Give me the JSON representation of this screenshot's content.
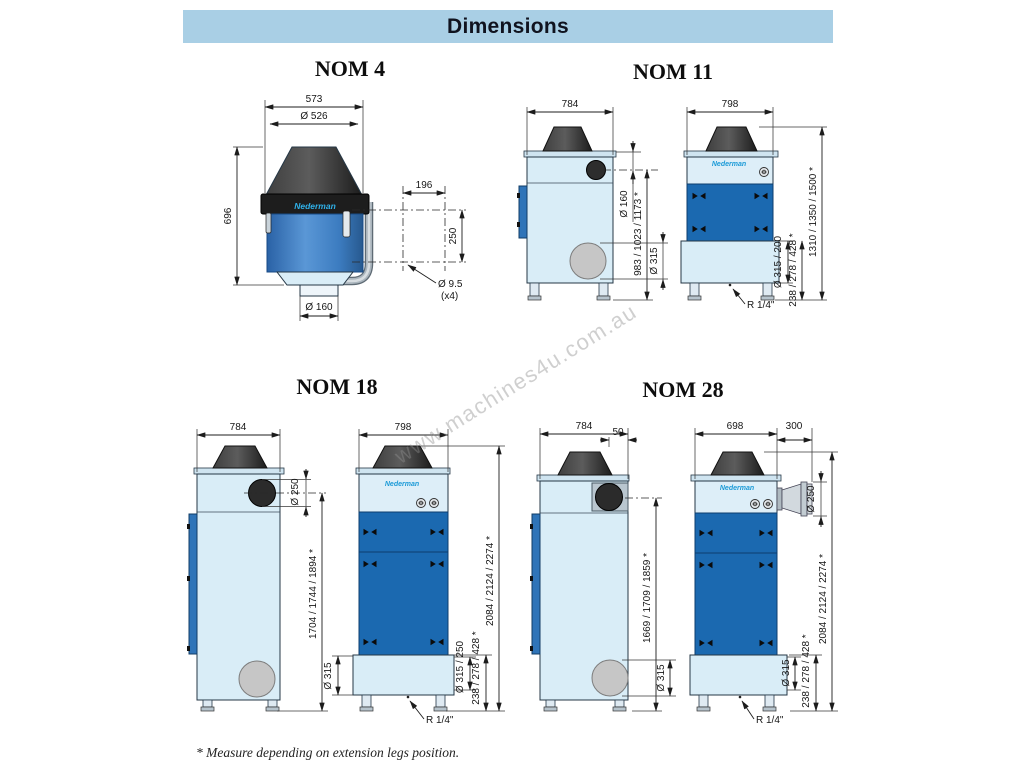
{
  "header": {
    "title": "Dimensions"
  },
  "brand": {
    "logo": "Nederman"
  },
  "watermark": "www.machines4u.com.au",
  "footnote": "* Measure depending on extension legs position.",
  "colors": {
    "header_band": "#a9cfe5",
    "panel_light": "#d9edf7",
    "panel_dark": "#1b69b0",
    "body_blue": "#3c7cc0",
    "logo_blue": "#1b9ad7",
    "cone_gray": "#3f3f3f",
    "drain_gray": "#c6c6c6"
  },
  "nom4": {
    "title": "NOM 4",
    "dims": {
      "overall_width": "573",
      "lid_diameter": "Ø 526",
      "height": "696",
      "hole_pattern_width": "196",
      "hole_pattern_height": "250",
      "hole_diameter": "Ø 9.5",
      "hole_count": "(x4)",
      "outlet_diameter": "Ø 160"
    }
  },
  "nom11": {
    "title": "NOM 11",
    "dims": {
      "depth": "784",
      "width": "798",
      "inlet_diameter": "Ø 160",
      "inlet_height": "983 / 1023 / 1173 *",
      "drain_diameter": "Ø 315",
      "outlet_connection": "Ø 315 / 200",
      "base_height": "238 / 278 / 428 *",
      "total_height": "1310 / 1350 / 1500 *",
      "drain_thread": "R 1/4\""
    }
  },
  "nom18": {
    "title": "NOM 18",
    "dims": {
      "depth": "784",
      "width": "798",
      "inlet_diameter": "Ø 250",
      "inlet_height": "1704 / 1744 / 1894 *",
      "base_connection": "Ø 315",
      "outlet_connection": "Ø 315 / 250",
      "base_height": "238 / 278 / 428 *",
      "total_height": "2084 / 2124 / 2274 *",
      "drain_thread": "R 1/4\""
    }
  },
  "nom28": {
    "title": "NOM 28",
    "dims": {
      "depth": "784",
      "rear_offset": "50",
      "width": "698",
      "outlet_length": "300",
      "outlet_diameter": "Ø 250",
      "inlet_height": "1669 / 1709 / 1859 *",
      "drain_diameter": "Ø 315",
      "base_connection": "Ø 315",
      "base_height": "238 / 278 / 428 *",
      "total_height": "2084 / 2124 / 2274 *",
      "drain_thread": "R 1/4\""
    }
  }
}
